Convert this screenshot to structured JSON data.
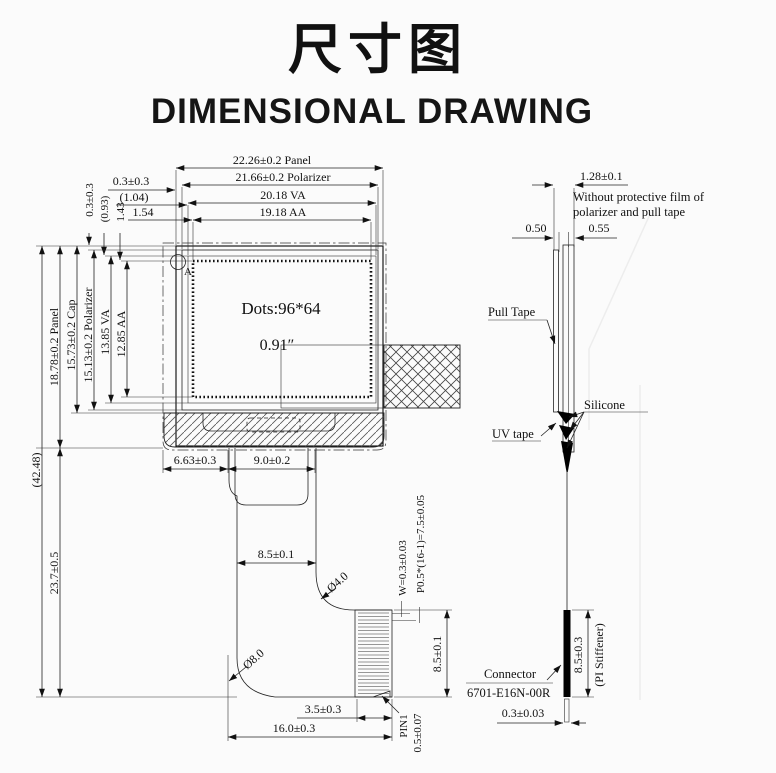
{
  "title": {
    "cn": "尺寸图",
    "en": "DIMENSIONAL DRAWING"
  },
  "front_view": {
    "top_dims": {
      "panel": "22.26±0.2 Panel",
      "polarizer": "21.66±0.2 Polarizer",
      "va": "20.18 VA",
      "aa": "19.18 AA"
    },
    "corner_dims": {
      "h_offset": "0.3±0.3",
      "h_va": "(1.04)",
      "h_aa": "1.54",
      "v_offset": "0.3±0.3",
      "v_va": "(0.93)",
      "v_aa": "1.43"
    },
    "left_dims": {
      "total": "(42.48)",
      "panel": "18.78±0.2 Panel",
      "cap": "15.73±0.2 Cap",
      "polarizer": "15.13±0.2 Polarizer",
      "va": "13.85 VA",
      "aa": "12.85 AA",
      "fpc": "23.7±0.5"
    },
    "display": {
      "dots": "Dots:96*64",
      "diagonal": "0.91″",
      "detail_mark": "A"
    },
    "fpc_dims": {
      "offset": "6.63±0.3",
      "tab": "9.0±0.2",
      "neck": "8.5±0.1",
      "bend_r_small": "Ø4.0",
      "bend_r_big": "Ø8.0",
      "pin_width": "W=0.3±0.03",
      "pin_pitch": "P0.5*(16-1)=7.5±0.05",
      "connector_h": "8.5±0.1",
      "tail": "3.5±0.3",
      "total_w": "16.0±0.3",
      "pin1": "PIN1",
      "pin_offset": "0.5±0.07"
    }
  },
  "side_view": {
    "thickness": "1.28±0.1",
    "note_line1": "Without protective film of",
    "note_line2": "polarizer and pull tape",
    "t_tape": "0.50",
    "t_panel": "0.55",
    "labels": {
      "pull_tape": "Pull Tape",
      "silicone": "Silicone",
      "uv_tape": "UV tape",
      "connector": "Connector",
      "connector_model": "6701-E16N-00R",
      "stiffener_h": "8.5±0.3",
      "stiffener": "(PI Stiffener)",
      "tail_t": "0.3±0.03"
    }
  }
}
